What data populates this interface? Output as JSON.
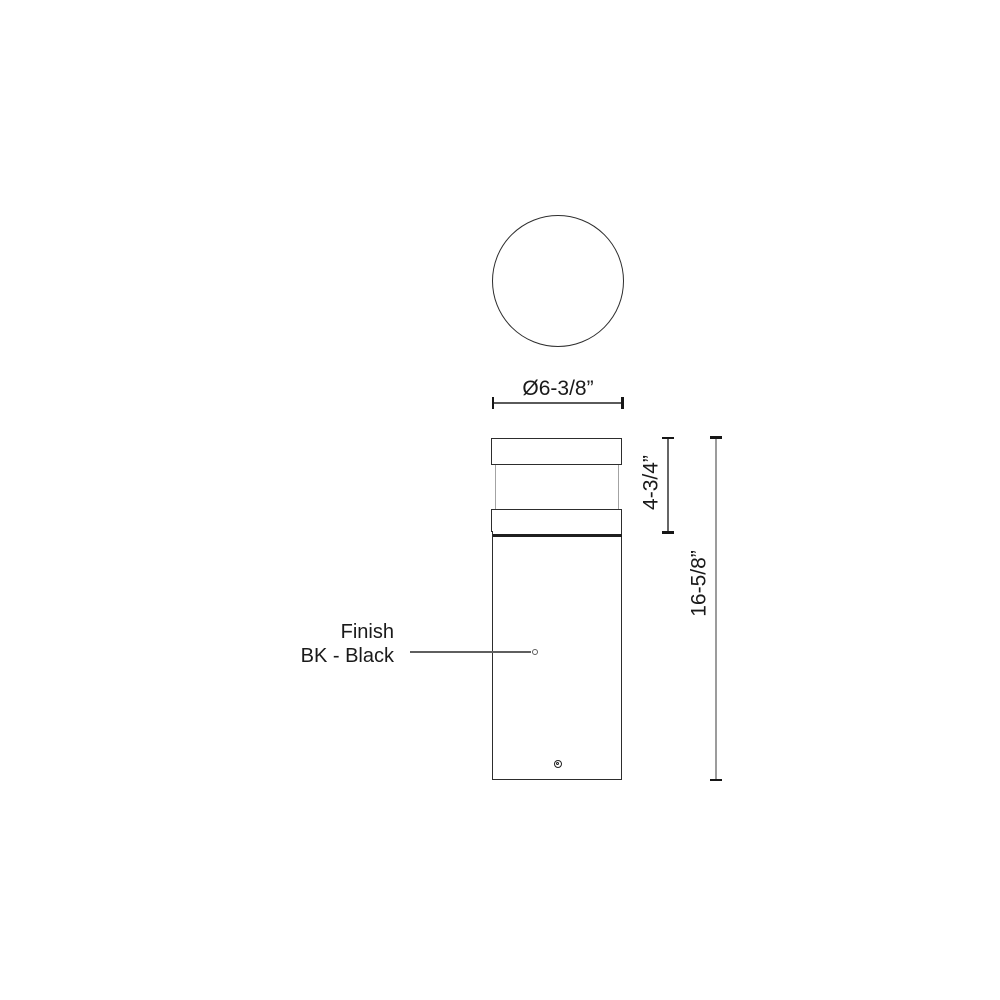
{
  "drawing": {
    "top_view": {
      "diameter_label": "Ø6-3/8”"
    },
    "front_view": {
      "head_height_label": "4-3/4”",
      "overall_height_label": "16-5/8”"
    },
    "finish_callout": {
      "line1": "Finish",
      "line2": "BK - Black"
    },
    "colors": {
      "outline": "#2d2d2d",
      "dimension_line": "#9c9c9c",
      "text": "#1a1a1a",
      "background": "#ffffff"
    }
  }
}
